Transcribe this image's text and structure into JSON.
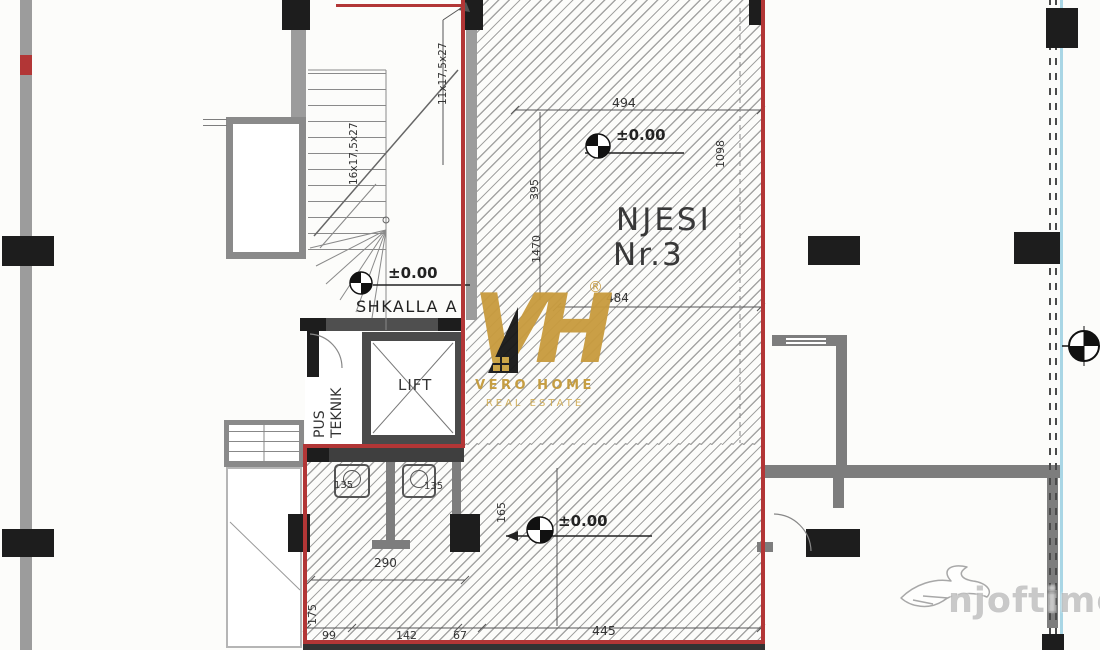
{
  "plan": {
    "unit": {
      "line1": "NJESI",
      "line2": "Nr.3"
    },
    "rooms": {
      "stair_label": "SHKALLA A",
      "lift_label": "LIFT",
      "shaft_line1": "PUS",
      "shaft_line2": "TEKNIK"
    },
    "levels": {
      "entry": "±0.00",
      "stair": "±0.00",
      "hall": "±0.00"
    },
    "stairs": {
      "flight_left": "16x17,5x27",
      "flight_right": "11x17,5x27"
    },
    "dimensions": {
      "top_width": "494",
      "mid_width": "484",
      "bottom_width": "445",
      "wc_width": "290",
      "strip_a": "99",
      "strip_b": "142",
      "strip_c": "67",
      "stall_left": "135",
      "stall_right": "135",
      "v_upper": "395",
      "v_total": "1470",
      "v_right": "1098",
      "v_wc": "165",
      "v_lower_left": "175"
    },
    "colors": {
      "boundary_red": "#b23636",
      "wall_gray": "#7d7d7d",
      "column_black": "#1d1d1d",
      "facade_blue": "#a9d6e5",
      "brand_gold": "#c89b3d"
    }
  },
  "watermarks": {
    "brand": {
      "monogram": "VH",
      "registered": "®",
      "name": "VERO HOME",
      "tagline": "REAL ESTATE"
    },
    "portal": {
      "text": "njoftime.al"
    }
  }
}
